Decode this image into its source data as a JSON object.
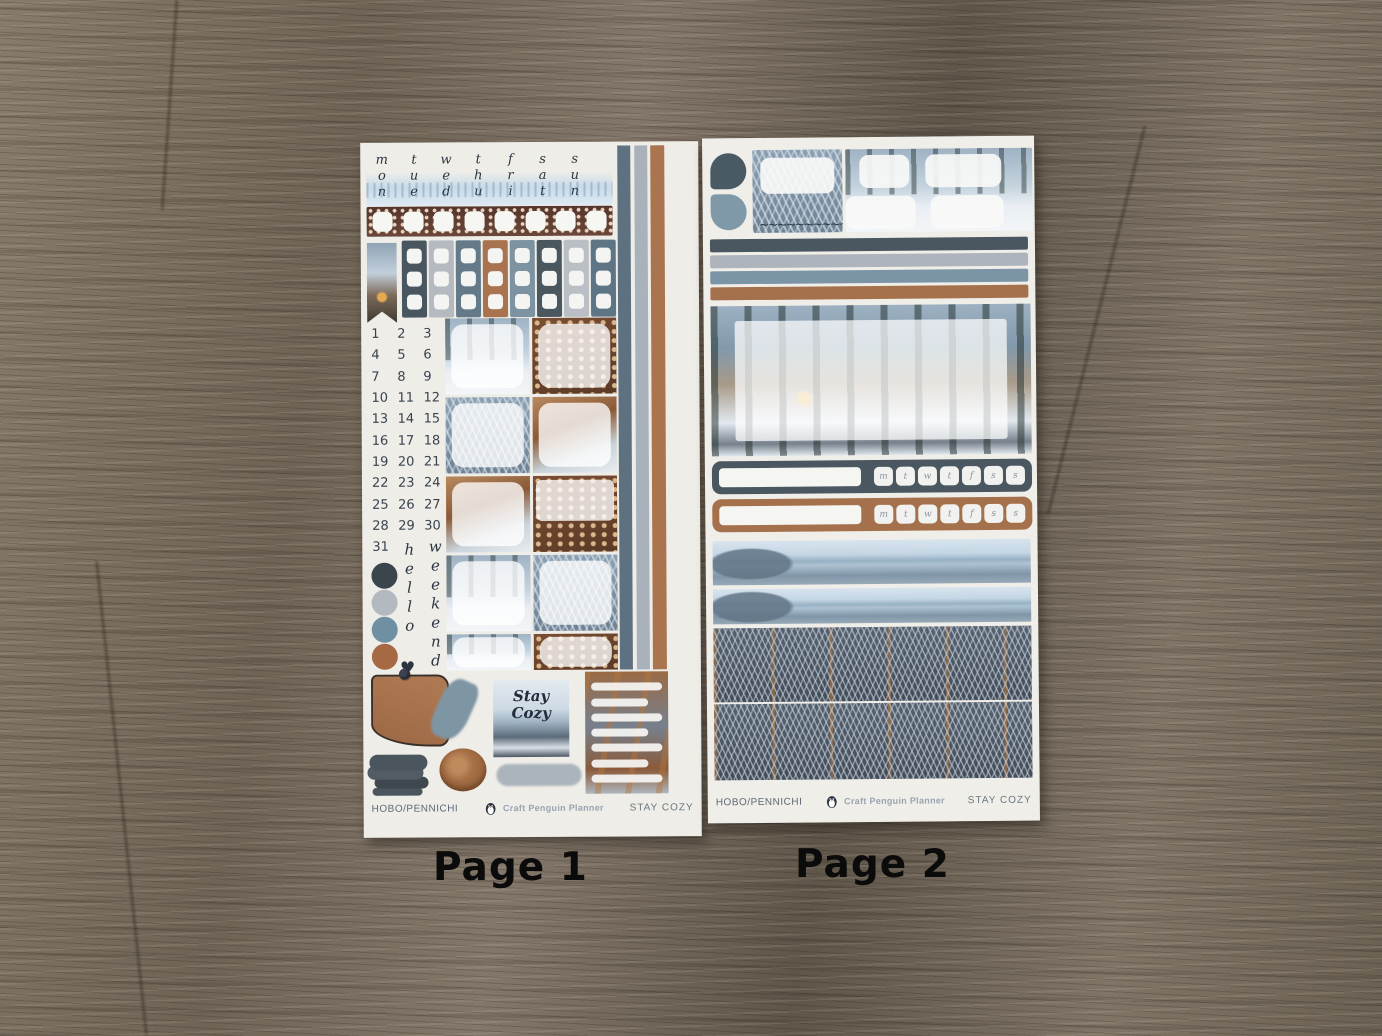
{
  "page_labels": {
    "left": "Page 1",
    "right": "Page 2"
  },
  "sheet1": {
    "weekday_headers": [
      "mon",
      "tue",
      "wed",
      "thu",
      "fri",
      "sat",
      "sun"
    ],
    "dates": [
      "1",
      "2",
      "3",
      "4",
      "5",
      "6",
      "7",
      "8",
      "9",
      "10",
      "11",
      "12",
      "13",
      "14",
      "15",
      "16",
      "17",
      "18",
      "19",
      "20",
      "21",
      "22",
      "23",
      "24",
      "25",
      "26",
      "27",
      "28",
      "29",
      "30",
      "31"
    ],
    "hello_text": "hello",
    "weekend_text": "weekend",
    "heart": "♥",
    "quote": {
      "line1": "Stay",
      "line2": "Cozy"
    },
    "footer": {
      "left": "HOBO/PENNICHI",
      "brand": "Craft Penguin Planner",
      "right": "STAY COZY"
    }
  },
  "sheet2": {
    "tracker_days": [
      "m",
      "t",
      "w",
      "t",
      "f",
      "s",
      "s"
    ],
    "scribble": "~~~~~~~~~~~",
    "footer": {
      "left": "HOBO/PENNICHI",
      "brand": "Craft Penguin Planner",
      "right": "STAY COZY"
    }
  },
  "kit_palette": {
    "charcoal": "#3a454e",
    "gray": "#b2b9bf",
    "blue": "#6f8fa3",
    "brown": "#a56a43"
  }
}
